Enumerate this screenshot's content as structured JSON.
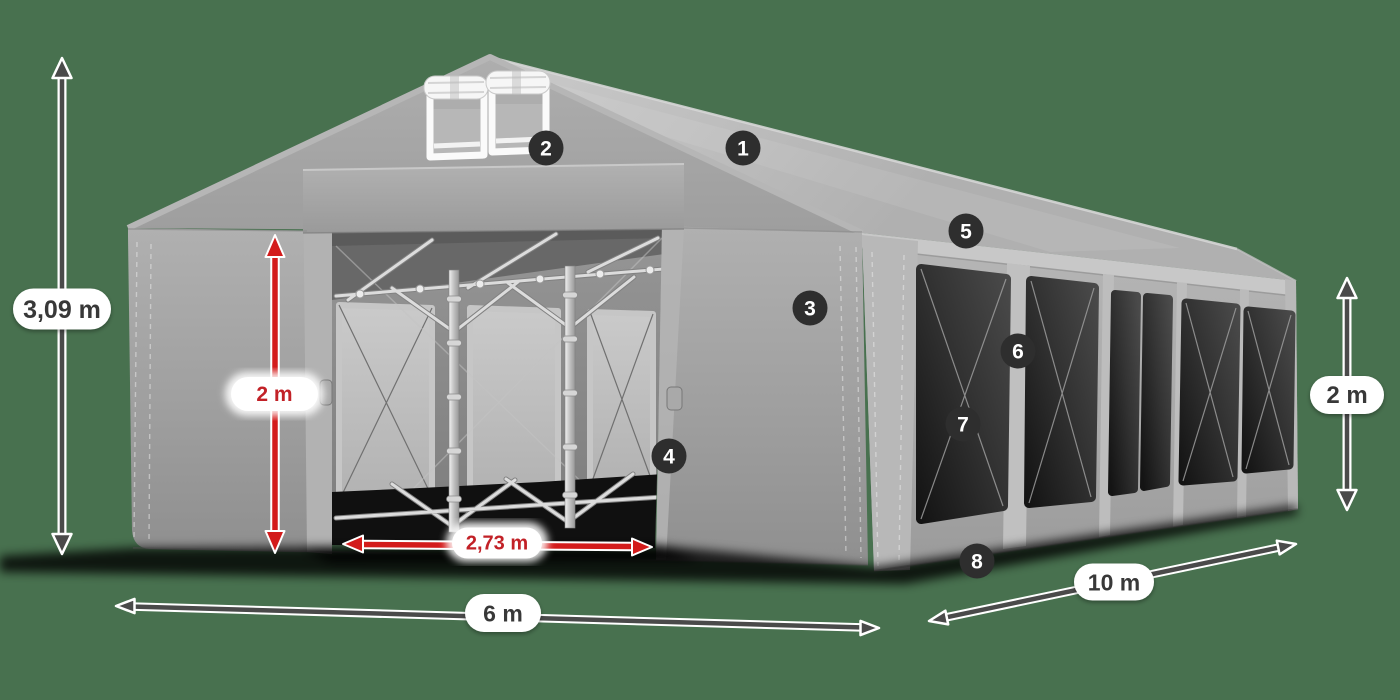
{
  "scene": {
    "background_color": "#48714f"
  },
  "colors": {
    "background": "#48714f",
    "badge_background": "#2e2e2e",
    "badge_number": "#ffffff",
    "dimension_dark": "#4a4a4a",
    "dimension_red": "#d31b1b",
    "label_text_dark": "#383838",
    "label_text_red": "#c22127",
    "pill_background": "#ffffff"
  },
  "badges": {
    "b1": "1",
    "b2": "2",
    "b3": "3",
    "b4": "4",
    "b5": "5",
    "b6": "6",
    "b7": "7",
    "b8": "8"
  },
  "dimensions": {
    "total_height": {
      "label": "3,09 m",
      "style": "dark"
    },
    "door_height": {
      "label": "2 m",
      "style": "red"
    },
    "door_width": {
      "label": "2,73 m",
      "style": "red"
    },
    "front_width": {
      "label": "6 m",
      "style": "dark"
    },
    "side_length": {
      "label": "10 m",
      "style": "dark"
    },
    "side_height": {
      "label": "2 m",
      "style": "dark"
    }
  }
}
